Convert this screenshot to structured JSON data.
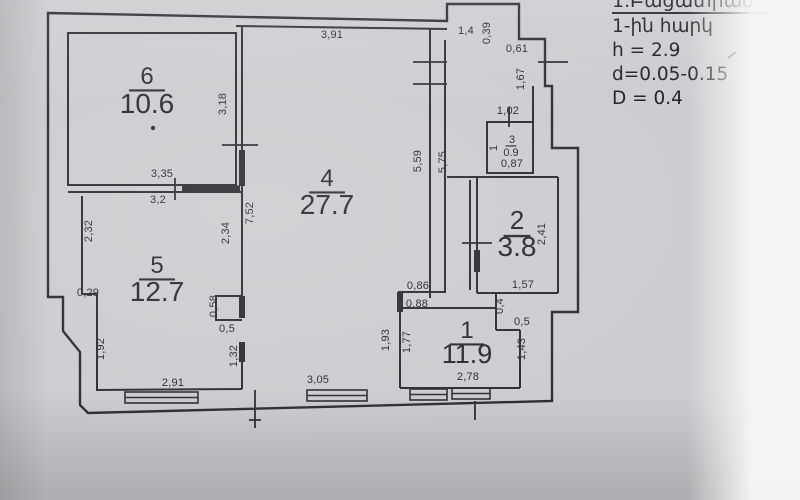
{
  "notes": {
    "title": "1.Բացատրած",
    "lines": [
      "1-ին հարկ",
      "h = 2.9",
      "d=0.05-0.15",
      "D = 0.4"
    ]
  },
  "colors": {
    "ink": "#2e2e33",
    "paper": "#cdccd0"
  },
  "rooms": [
    {
      "number": "6",
      "area": "10.6",
      "nx": 147,
      "ny": 84,
      "ax": 147,
      "ay": 113,
      "ns": 24,
      "as": 28
    },
    {
      "number": "4",
      "area": "27.7",
      "nx": 327,
      "ny": 186,
      "ax": 327,
      "ay": 214,
      "ns": 24,
      "as": 28
    },
    {
      "number": "5",
      "area": "12.7",
      "nx": 157,
      "ny": 273,
      "ax": 157,
      "ay": 301,
      "ns": 24,
      "as": 28
    },
    {
      "number": "2",
      "area": "3.8",
      "nx": 517,
      "ny": 229,
      "ax": 517,
      "ay": 256,
      "ns": 26,
      "as": 28
    },
    {
      "number": "1",
      "area": "11.9",
      "nx": 467,
      "ny": 338,
      "ax": 467,
      "ay": 363,
      "ns": 24,
      "as": 27
    },
    {
      "number": "3",
      "area": "0.9",
      "nx": 512,
      "ny": 143,
      "ax": 511,
      "ay": 156,
      "ns": 11,
      "as": 11
    }
  ],
  "dimensions": [
    {
      "v": "3,91",
      "x": 332,
      "y": 38
    },
    {
      "v": "1,4",
      "x": 466,
      "y": 34
    },
    {
      "v": "0,39",
      "x": 490,
      "y": 33,
      "r": -90
    },
    {
      "v": "0,61",
      "x": 517,
      "y": 52
    },
    {
      "v": "1,67",
      "x": 524,
      "y": 79,
      "r": -90
    },
    {
      "v": "1,02",
      "x": 508,
      "y": 114
    },
    {
      "v": "1",
      "x": 497,
      "y": 148,
      "r": -90,
      "s": 10
    },
    {
      "v": "0,87",
      "x": 512,
      "y": 167,
      "s": 10.5
    },
    {
      "v": "3,18",
      "x": 226,
      "y": 104,
      "r": -90
    },
    {
      "v": "3,35",
      "x": 162,
      "y": 177
    },
    {
      "v": "3,2",
      "x": 158,
      "y": 203
    },
    {
      "v": "7,52",
      "x": 253,
      "y": 213,
      "r": -90
    },
    {
      "v": "5,59",
      "x": 421,
      "y": 161,
      "r": -90
    },
    {
      "v": "5,75",
      "x": 446,
      "y": 162,
      "r": -90
    },
    {
      "v": "2,32",
      "x": 92,
      "y": 231,
      "r": -90
    },
    {
      "v": "2,34",
      "x": 229,
      "y": 233,
      "r": -90
    },
    {
      "v": "0,29",
      "x": 88,
      "y": 296
    },
    {
      "v": "0,58",
      "x": 217,
      "y": 306,
      "r": -90
    },
    {
      "v": "0,5",
      "x": 227,
      "y": 332
    },
    {
      "v": "1,32",
      "x": 237,
      "y": 356,
      "r": -90
    },
    {
      "v": "1,92",
      "x": 104,
      "y": 349,
      "r": -90
    },
    {
      "v": "2,91",
      "x": 173,
      "y": 386
    },
    {
      "v": "3,05",
      "x": 318,
      "y": 383
    },
    {
      "v": "1,93",
      "x": 389,
      "y": 340,
      "r": -90
    },
    {
      "v": "1,77",
      "x": 410,
      "y": 342,
      "r": -90
    },
    {
      "v": "0,86",
      "x": 418,
      "y": 289
    },
    {
      "v": "0,88",
      "x": 417,
      "y": 307
    },
    {
      "v": "0,4",
      "x": 503,
      "y": 306,
      "r": -90
    },
    {
      "v": "0,5",
      "x": 522,
      "y": 325
    },
    {
      "v": "1,43",
      "x": 525,
      "y": 349,
      "r": -90
    },
    {
      "v": "2,78",
      "x": 468,
      "y": 380
    },
    {
      "v": "1,57",
      "x": 523,
      "y": 288
    },
    {
      "v": "2,41",
      "x": 545,
      "y": 234,
      "r": -90
    }
  ]
}
